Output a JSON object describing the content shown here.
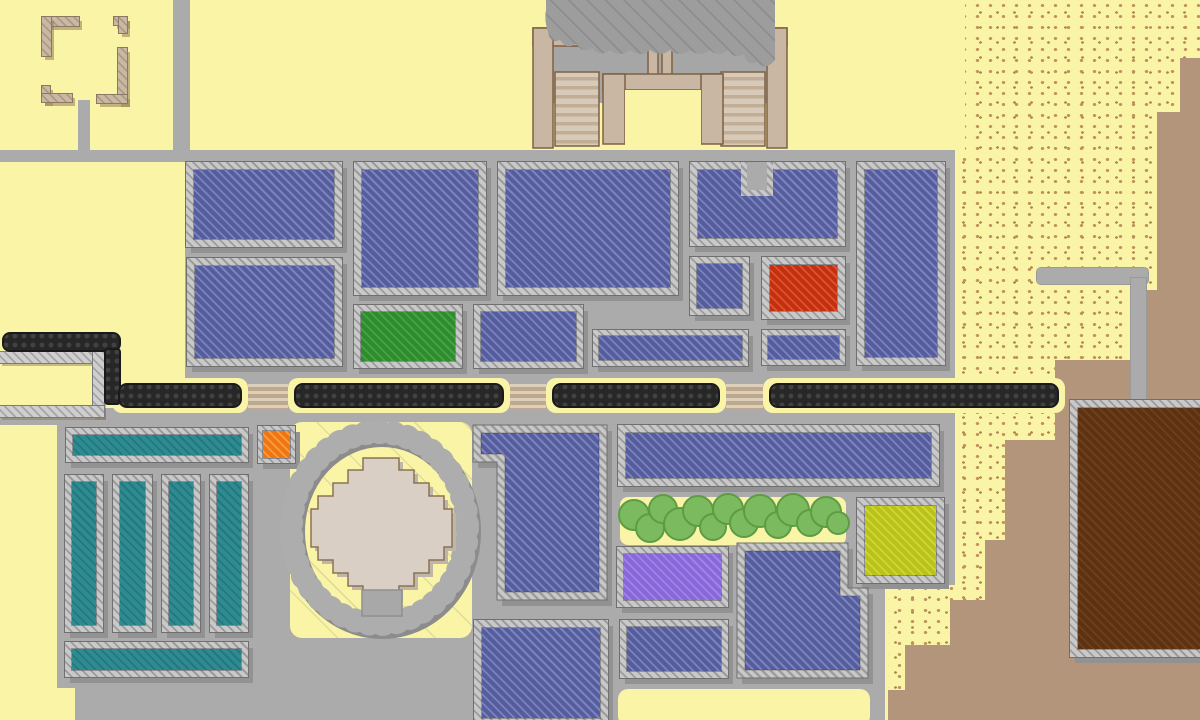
{
  "palette": {
    "background_sand": "#FAF4A6",
    "plaza_gray": "#ABABAB",
    "sand_speckle": "#C0915E",
    "rock_tan": "#B3957C",
    "border_hatch_light": "#C9C9C9",
    "border_hatch_dark": "#9C9C9C",
    "shadow_gray": "#929292",
    "wall_black": "#272727",
    "temple_tan": "#C9B7A3",
    "temple_brown": "#7D6142",
    "stair_light": "#D8CAB8",
    "stair_dark": "#C2AE97",
    "cliff_gray": "#9D9D9D",
    "cliff_hatch": "#8C8C8C",
    "tree_green": "#7CBA5F",
    "tree_outline": "#5E9C44",
    "diamond_fill": "#D9CFC4",
    "diamond_outline": "#8B7355",
    "ring_gray": "#A0A0A0",
    "building_types": {
      "blue": [
        "#555D9D",
        "#7B83BE"
      ],
      "green": [
        "#2E8B2E",
        "#45A245"
      ],
      "red": [
        "#C42F10",
        "#DA5430"
      ],
      "orange": [
        "#EE7511",
        "#FB9C3F"
      ],
      "teal": [
        "#2D8C91",
        "#26767D"
      ],
      "purple": [
        "#8767D9",
        "#9F84E4"
      ],
      "lime": [
        "#B9C217",
        "#CDD63B"
      ],
      "brown": [
        "#5B3213",
        "#703F1A"
      ]
    }
  },
  "terrain": {
    "sand_region": {
      "box": [
        880,
        0,
        320,
        720
      ],
      "clip": "polygon(85px 0px,320px 0px,320px 720px,8px 720px,8px 585px,75px 585px,75px 150px,85px 150px)"
    },
    "tan_path": "M1200,58 L1180,58 L1180,112 L1157,112 L1157,290 L1146,290 L1146,360 L1055,360 L1055,440 L1005,440 L1005,540 L985,540 L985,600 L950,600 L950,645 L905,645 L905,690 L888,690 L888,726 L1200,726 Z",
    "plaza_rects": [
      [
        0,
        150,
        955,
        12
      ],
      [
        185,
        162,
        770,
        423
      ],
      [
        0,
        408,
        185,
        17
      ],
      [
        57,
        425,
        128,
        160
      ],
      [
        57,
        585,
        828,
        103
      ],
      [
        75,
        688,
        810,
        32
      ]
    ],
    "roads": [
      {
        "n": "road-north-vertical",
        "box": [
          173,
          0,
          17,
          150
        ],
        "edged": false,
        "r": 0
      },
      {
        "n": "road-ruin-stub",
        "box": [
          78,
          100,
          12,
          52
        ],
        "edged": false,
        "r": 0
      },
      {
        "n": "road-east-horizontal",
        "box": [
          1037,
          268,
          111,
          16
        ],
        "edged": true,
        "r": 4
      },
      {
        "n": "road-east-vertical",
        "box": [
          1131,
          278,
          15,
          128
        ],
        "edged": true,
        "r": 0
      }
    ],
    "yellow_patches": [
      {
        "n": "circle-compound-yard",
        "box": [
          290,
          422,
          182,
          216
        ],
        "r": 12,
        "hatch": true
      },
      {
        "n": "south-plaza-yard",
        "box": [
          618,
          689,
          252,
          37
        ],
        "r": 10,
        "hatch": false
      },
      {
        "n": "grove-strip",
        "box": [
          620,
          497,
          226,
          48
        ],
        "r": 8,
        "hatch": false
      }
    ]
  },
  "ruins": [
    {
      "n": "ruin-wall-piece",
      "box": [
        42,
        17,
        37,
        9
      ]
    },
    {
      "n": "ruin-wall-piece",
      "box": [
        42,
        17,
        9,
        39
      ]
    },
    {
      "n": "ruin-wall-piece",
      "box": [
        114,
        17,
        13,
        8
      ]
    },
    {
      "n": "ruin-wall-piece",
      "box": [
        119,
        17,
        8,
        16
      ]
    },
    {
      "n": "ruin-wall-piece",
      "box": [
        118,
        48,
        9,
        55
      ]
    },
    {
      "n": "ruin-wall-piece",
      "box": [
        97,
        95,
        30,
        8
      ]
    },
    {
      "n": "ruin-wall-piece",
      "box": [
        42,
        86,
        8,
        16
      ]
    },
    {
      "n": "ruin-wall-piece",
      "box": [
        42,
        94,
        30,
        8
      ]
    }
  ],
  "enclosure_walls": [
    {
      "n": "yard-wall-north",
      "box": [
        0,
        352,
        104,
        11
      ]
    },
    {
      "n": "yard-wall-east",
      "box": [
        93,
        352,
        11,
        65
      ]
    },
    {
      "n": "yard-wall-south",
      "box": [
        0,
        406,
        104,
        11
      ]
    }
  ],
  "city_wall": {
    "pills": [
      [
        112,
        378,
        136,
        35
      ],
      [
        288,
        378,
        222,
        35
      ],
      [
        546,
        378,
        180,
        35
      ],
      [
        763,
        378,
        302,
        35
      ]
    ],
    "segments": [
      {
        "n": "city-wall-segment-1",
        "box": [
          118,
          383,
          124,
          25
        ]
      },
      {
        "n": "city-wall-segment-2",
        "box": [
          294,
          383,
          210,
          25
        ]
      },
      {
        "n": "city-wall-segment-3",
        "box": [
          552,
          383,
          168,
          25
        ]
      },
      {
        "n": "city-wall-segment-4",
        "box": [
          769,
          383,
          290,
          25
        ]
      }
    ],
    "west_horizontal": {
      "n": "city-wall-west",
      "box": [
        2,
        332,
        119,
        20
      ]
    },
    "west_vertical": {
      "n": "city-wall-west-connector",
      "box": [
        104,
        348,
        17,
        57
      ]
    },
    "gates": [
      {
        "n": "wall-gate-1",
        "box": [
          248,
          384,
          40,
          26
        ]
      },
      {
        "n": "wall-gate-2",
        "box": [
          510,
          384,
          36,
          26
        ]
      },
      {
        "n": "wall-gate-3",
        "box": [
          726,
          384,
          37,
          26
        ]
      }
    ]
  },
  "temple": {
    "gray_base": [
      553,
      45,
      215,
      58
    ],
    "courtyard": [
      625,
      90,
      76,
      56
    ],
    "walls": [
      [
        533,
        28,
        55,
        18
      ],
      [
        533,
        28,
        20,
        120
      ],
      [
        732,
        28,
        55,
        18
      ],
      [
        767,
        28,
        20,
        120
      ],
      [
        648,
        0,
        10,
        78
      ],
      [
        662,
        0,
        10,
        78
      ],
      [
        603,
        74,
        120,
        16
      ],
      [
        603,
        74,
        22,
        70
      ],
      [
        701,
        74,
        22,
        70
      ]
    ],
    "stairs": [
      [
        555,
        72,
        44,
        74
      ],
      [
        721,
        72,
        44,
        74
      ],
      [
        569,
        18,
        30,
        28
      ],
      [
        721,
        18,
        30,
        28
      ],
      [
        602,
        18,
        44,
        28
      ],
      [
        674,
        18,
        44,
        28
      ]
    ],
    "cliff_path": "M546,0 H775 V60 Q765,72 757,62 Q746,66 744,54 Q734,60 728,50 Q718,58 710,50 Q700,58 690,50 Q680,58 670,50 Q660,58 650,50 Q640,58 630,50 Q620,58 610,50 Q600,58 592,48 Q582,54 576,44 Q566,50 560,40 Q550,44 548,32 Q544,20 546,10 Z"
  },
  "buildings": [
    {
      "n": "building-blue-1",
      "t": "blue",
      "box": [
        186,
        162,
        156,
        85
      ],
      "bw": 8
    },
    {
      "n": "building-blue-2",
      "t": "blue",
      "box": [
        187,
        258,
        155,
        108
      ],
      "bw": 8
    },
    {
      "n": "building-blue-3",
      "t": "blue",
      "box": [
        354,
        162,
        132,
        133
      ],
      "bw": 8
    },
    {
      "n": "building-green",
      "t": "green",
      "box": [
        354,
        305,
        108,
        63
      ],
      "bw": 7
    },
    {
      "n": "building-blue-4",
      "t": "blue",
      "box": [
        474,
        305,
        109,
        63
      ],
      "bw": 7
    },
    {
      "n": "building-blue-5",
      "t": "blue",
      "box": [
        498,
        162,
        180,
        133
      ],
      "bw": 8
    },
    {
      "n": "building-blue-strip-1",
      "t": "blue",
      "box": [
        593,
        330,
        155,
        36
      ],
      "bw": 6
    },
    {
      "n": "building-blue-notched-top",
      "t": "blue",
      "box": [
        690,
        162,
        155,
        84
      ],
      "bw": 8
    },
    {
      "n": "building-blue-6",
      "t": "blue",
      "box": [
        690,
        257,
        59,
        58
      ],
      "bw": 7
    },
    {
      "n": "building-red",
      "t": "red",
      "box": [
        762,
        257,
        83,
        62
      ],
      "bw": 8
    },
    {
      "n": "building-blue-strip-2",
      "t": "blue",
      "box": [
        762,
        330,
        83,
        35
      ],
      "bw": 6
    },
    {
      "n": "building-blue-tall",
      "t": "blue",
      "box": [
        857,
        162,
        88,
        203
      ],
      "bw": 8
    },
    {
      "n": "building-orange-small",
      "t": "orange",
      "box": [
        258,
        426,
        37,
        37
      ],
      "bw": 5
    },
    {
      "n": "building-blue-south-1",
      "t": "blue",
      "box": [
        474,
        620,
        134,
        106
      ],
      "bw": 8
    },
    {
      "n": "building-blue-wide",
      "t": "blue",
      "box": [
        618,
        425,
        321,
        61
      ],
      "bw": 8
    },
    {
      "n": "building-lime",
      "t": "lime",
      "box": [
        857,
        498,
        87,
        85
      ],
      "bw": 8
    },
    {
      "n": "building-purple",
      "t": "purple",
      "box": [
        617,
        547,
        111,
        60
      ],
      "bw": 7
    },
    {
      "n": "building-blue-south-2",
      "t": "blue",
      "box": [
        620,
        620,
        108,
        58
      ],
      "bw": 7
    },
    {
      "n": "building-brown-large",
      "t": "brown",
      "box": [
        1070,
        400,
        140,
        257
      ],
      "bw": 8
    },
    {
      "n": "field-teal-1",
      "t": "teal",
      "box": [
        66,
        428,
        182,
        34
      ],
      "bw": 7
    },
    {
      "n": "field-teal-2",
      "t": "teal",
      "box": [
        65,
        475,
        38,
        157
      ],
      "bw": 7
    },
    {
      "n": "field-teal-3",
      "t": "teal",
      "box": [
        113,
        475,
        39,
        157
      ],
      "bw": 7
    },
    {
      "n": "field-teal-4",
      "t": "teal",
      "box": [
        162,
        475,
        38,
        157
      ],
      "bw": 7
    },
    {
      "n": "field-teal-5",
      "t": "teal",
      "box": [
        210,
        475,
        38,
        157
      ],
      "bw": 7
    },
    {
      "n": "field-teal-6",
      "t": "teal",
      "box": [
        65,
        642,
        183,
        35
      ],
      "bw": 7
    }
  ],
  "special_buildings": {
    "l_shape": {
      "n": "building-blue-l-shape",
      "outer": "473,425 607,425 607,600 497,600 497,462 473,462",
      "inner": "481,433 599,433 599,592 505,592 505,454 481,454"
    },
    "notched": {
      "n": "building-blue-step",
      "outer": "737,543 848,543 848,588 868,588 868,678 737,678",
      "inner": "745,551 840,551 840,596 860,596 860,670 745,670"
    },
    "notch_patch": {
      "hatch": [
        741,
        162,
        32,
        34
      ],
      "plaza": [
        747,
        162,
        20,
        28
      ]
    }
  },
  "circle_compound": {
    "ring": {
      "cx": 379,
      "cy": 528,
      "rx": 88,
      "ry": 96,
      "width": 20
    },
    "diamond_points": "363,458 399,458 399,470 414,470 414,483 429,483 429,496 444,496 444,509 452,509 452,547 444,547 444,560 429,560 429,573 414,573 414,586 399,586 399,598 363,598 363,586 348,586 348,573 333,573 333,560 318,560 318,547 311,547 311,509 318,509 318,496 333,496 333,483 348,483 348,470 363,470",
    "entrance": [
      362,
      590,
      40,
      26
    ]
  },
  "trees": [
    [
      634,
      515,
      15
    ],
    [
      650,
      528,
      14
    ],
    [
      663,
      509,
      14
    ],
    [
      680,
      524,
      16
    ],
    [
      698,
      511,
      15
    ],
    [
      713,
      527,
      13
    ],
    [
      728,
      509,
      15
    ],
    [
      744,
      523,
      14
    ],
    [
      760,
      511,
      16
    ],
    [
      778,
      525,
      13
    ],
    [
      793,
      510,
      16
    ],
    [
      810,
      523,
      13
    ],
    [
      826,
      512,
      15
    ],
    [
      838,
      523,
      11
    ]
  ]
}
